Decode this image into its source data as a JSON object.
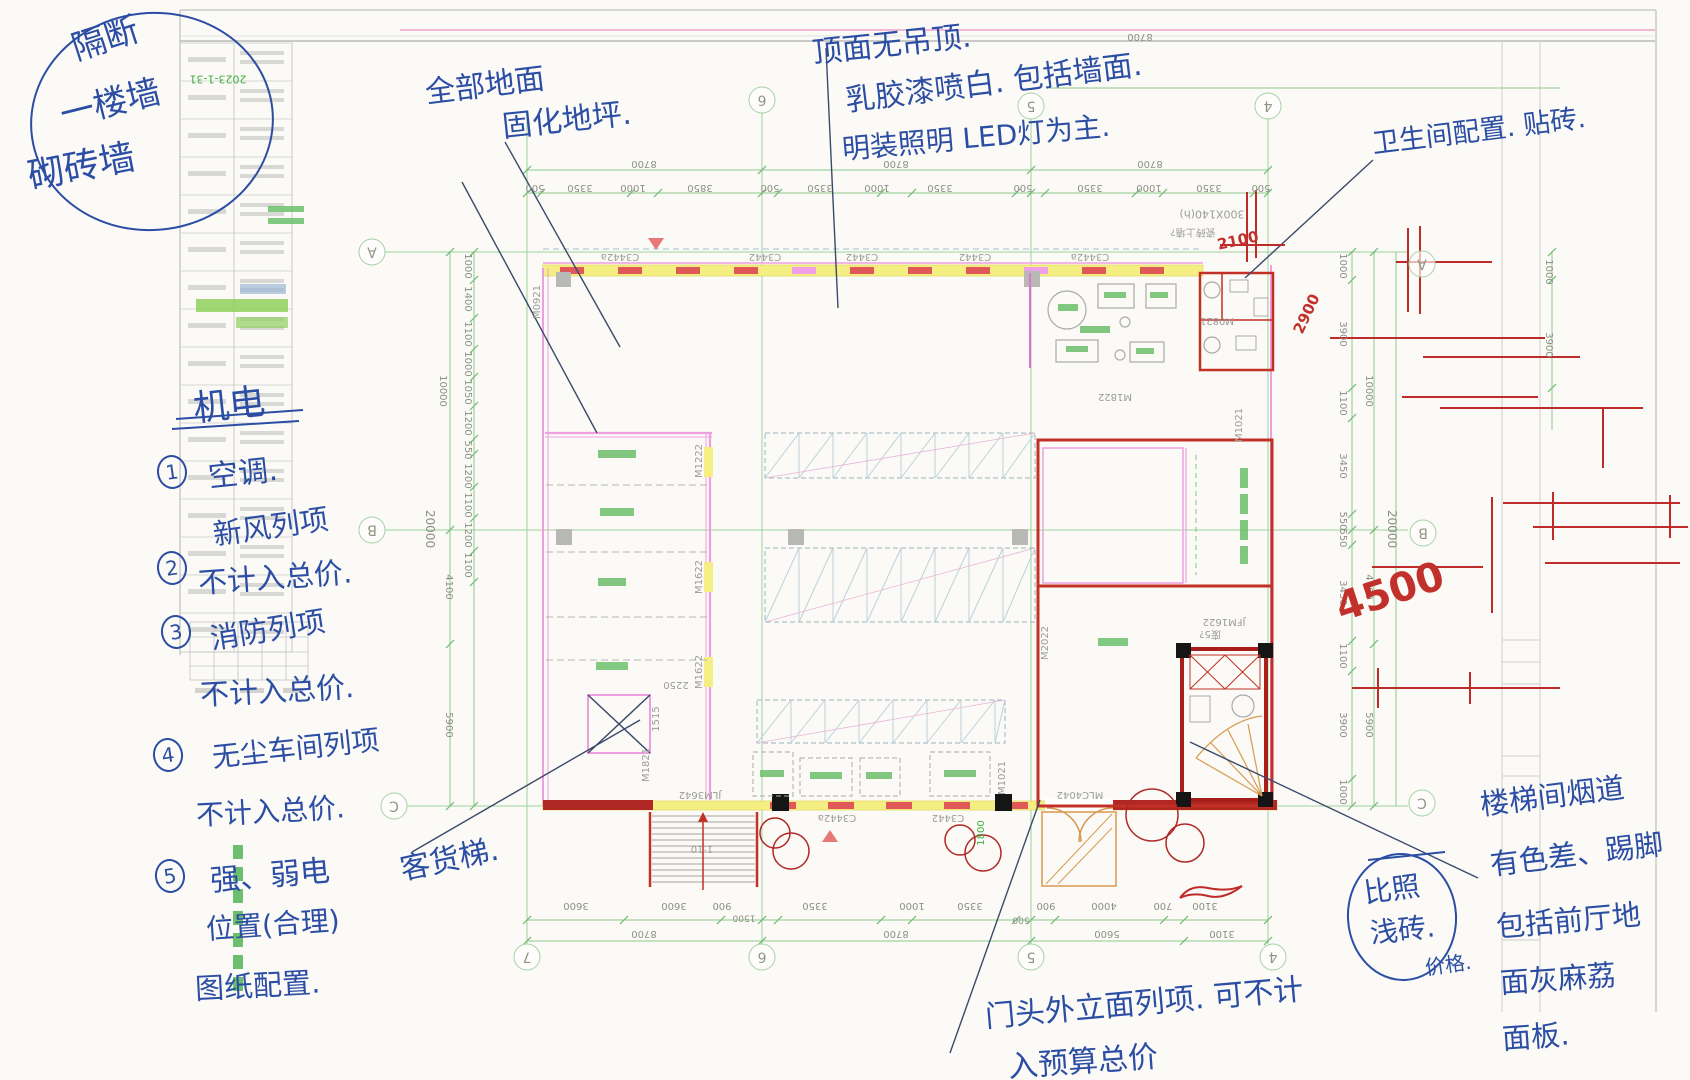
{
  "title_block": {
    "date": "2023-1-31"
  },
  "notes": {
    "circle": {
      "l1": "隔断",
      "l2": "一楼墙",
      "l3": "砌砖墙"
    },
    "floor": {
      "l1": "全部地面",
      "l2": "固化地坪."
    },
    "ceiling": {
      "l1": "顶面无吊顶.",
      "l2": "乳胶漆喷白. 包括墙面.",
      "l3": "明装照明 LED灯为主."
    },
    "washroom": "卫生间配置. 贴砖.",
    "mech": {
      "title": "机电",
      "n1": "1",
      "t1": "空调.",
      "n2": "2",
      "t2a": "新风列项",
      "t2b": "不计入总价.",
      "n3": "3",
      "t3a": "消防列项",
      "t3b": "不计入总价.",
      "n4": "4",
      "t4a": "无尘车间列项",
      "t4b": "不计入总价.",
      "n5": "5",
      "t5a": "强、弱电",
      "t5b": "位置(合理)",
      "t5c": "图纸配置."
    },
    "lift": "客货梯.",
    "entrance": {
      "l1": "门头外立面列项. 可不计",
      "l2": "入预算总价"
    },
    "stairwell": {
      "l1": "楼梯间烟道",
      "l2": "有色差、踢脚",
      "l3": "包括前厅地",
      "l4": "面灰麻荔",
      "l5": "面板."
    },
    "compare": {
      "l1": "比照",
      "l2": "浅砖.",
      "l3": "价格."
    }
  },
  "plan": {
    "labels": [
      {
        "t": "500",
        "x": 535,
        "y": 187,
        "r": 180,
        "k": "dim"
      },
      {
        "t": "3350",
        "x": 580,
        "y": 187,
        "r": 180,
        "k": "dim"
      },
      {
        "t": "1000",
        "x": 633,
        "y": 187,
        "r": 180,
        "k": "dim"
      },
      {
        "t": "3850",
        "x": 700,
        "y": 187,
        "r": 180,
        "k": "dim"
      },
      {
        "t": "500",
        "x": 770,
        "y": 187,
        "r": 180,
        "k": "dim"
      },
      {
        "t": "3350",
        "x": 820,
        "y": 187,
        "r": 180,
        "k": "dim"
      },
      {
        "t": "1000",
        "x": 877,
        "y": 187,
        "r": 180,
        "k": "dim"
      },
      {
        "t": "3350",
        "x": 940,
        "y": 187,
        "r": 180,
        "k": "dim"
      },
      {
        "t": "500",
        "x": 1023,
        "y": 187,
        "r": 180,
        "k": "dim"
      },
      {
        "t": "3350",
        "x": 1090,
        "y": 187,
        "r": 180,
        "k": "dim"
      },
      {
        "t": "1000",
        "x": 1149,
        "y": 187,
        "r": 180,
        "k": "dim"
      },
      {
        "t": "3350",
        "x": 1209,
        "y": 187,
        "r": 180,
        "k": "dim"
      },
      {
        "t": "500",
        "x": 1261,
        "y": 187,
        "r": 180,
        "k": "dim"
      },
      {
        "t": "8700",
        "x": 644,
        "y": 163,
        "r": 180,
        "k": "dim"
      },
      {
        "t": "8700",
        "x": 896,
        "y": 163,
        "r": 180,
        "k": "dim"
      },
      {
        "t": "8700",
        "x": 1150,
        "y": 163,
        "r": 180,
        "k": "dim"
      },
      {
        "t": "8700",
        "x": 1140,
        "y": 36,
        "r": 180,
        "k": "dim"
      },
      {
        "t": "3600",
        "x": 576,
        "y": 905,
        "r": 180,
        "k": "dim"
      },
      {
        "t": "3600",
        "x": 674,
        "y": 905,
        "r": 180,
        "k": "dim"
      },
      {
        "t": "900",
        "x": 722,
        "y": 905,
        "r": 180,
        "k": "dim"
      },
      {
        "t": "1500",
        "x": 744,
        "y": 917,
        "r": 180,
        "k": "dim",
        "s": 9
      },
      {
        "t": "3350",
        "x": 815,
        "y": 905,
        "r": 180,
        "k": "dim"
      },
      {
        "t": "1000",
        "x": 912,
        "y": 905,
        "r": 180,
        "k": "dim"
      },
      {
        "t": "3350",
        "x": 970,
        "y": 905,
        "r": 180,
        "k": "dim"
      },
      {
        "t": "500",
        "x": 1021,
        "y": 919,
        "r": 180,
        "k": "dim",
        "s": 9
      },
      {
        "t": "900",
        "x": 1046,
        "y": 905,
        "r": 180,
        "k": "dim"
      },
      {
        "t": "4000",
        "x": 1104,
        "y": 905,
        "r": 180,
        "k": "dim"
      },
      {
        "t": "700",
        "x": 1163,
        "y": 905,
        "r": 180,
        "k": "dim"
      },
      {
        "t": "3100",
        "x": 1205,
        "y": 905,
        "r": 180,
        "k": "dim"
      },
      {
        "t": "8700",
        "x": 644,
        "y": 933,
        "r": 180,
        "k": "dim"
      },
      {
        "t": "8700",
        "x": 896,
        "y": 933,
        "r": 180,
        "k": "dim"
      },
      {
        "t": "5600",
        "x": 1107,
        "y": 933,
        "r": 180,
        "k": "dim"
      },
      {
        "t": "3100",
        "x": 1222,
        "y": 933,
        "r": 180,
        "k": "dim"
      },
      {
        "t": "1000",
        "x": 467,
        "y": 266,
        "r": 90,
        "k": "dim"
      },
      {
        "t": "1400",
        "x": 467,
        "y": 299,
        "r": 90,
        "k": "dim"
      },
      {
        "t": "1100",
        "x": 467,
        "y": 334,
        "r": 90,
        "k": "dim"
      },
      {
        "t": "1000",
        "x": 467,
        "y": 364,
        "r": 90,
        "k": "dim"
      },
      {
        "t": "1050",
        "x": 467,
        "y": 392,
        "r": 90,
        "k": "dim"
      },
      {
        "t": "1200",
        "x": 467,
        "y": 423,
        "r": 90,
        "k": "dim"
      },
      {
        "t": "550",
        "x": 467,
        "y": 450,
        "r": 90,
        "k": "dim"
      },
      {
        "t": "1200",
        "x": 467,
        "y": 476,
        "r": 90,
        "k": "dim"
      },
      {
        "t": "1100",
        "x": 467,
        "y": 505,
        "r": 90,
        "k": "dim"
      },
      {
        "t": "1200",
        "x": 467,
        "y": 535,
        "r": 90,
        "k": "dim"
      },
      {
        "t": "1100",
        "x": 467,
        "y": 565,
        "r": 90,
        "k": "dim"
      },
      {
        "t": "10000",
        "x": 442,
        "y": 391,
        "r": 90,
        "k": "dim"
      },
      {
        "t": "20000",
        "x": 430,
        "y": 529,
        "r": 90,
        "k": "dim",
        "s": 12
      },
      {
        "t": "4100",
        "x": 448,
        "y": 587,
        "r": 90,
        "k": "dim"
      },
      {
        "t": "5900",
        "x": 448,
        "y": 725,
        "r": 90,
        "k": "dim"
      },
      {
        "t": "1000",
        "x": 1342,
        "y": 266,
        "r": 90,
        "k": "dim"
      },
      {
        "t": "3900",
        "x": 1342,
        "y": 334,
        "r": 90,
        "k": "dim"
      },
      {
        "t": "1100",
        "x": 1342,
        "y": 403,
        "r": 90,
        "k": "dim"
      },
      {
        "t": "3450",
        "x": 1342,
        "y": 466,
        "r": 90,
        "k": "dim"
      },
      {
        "t": "550",
        "x": 1342,
        "y": 521,
        "r": 90,
        "k": "dim"
      },
      {
        "t": "550",
        "x": 1342,
        "y": 538,
        "r": 90,
        "k": "dim"
      },
      {
        "t": "3450",
        "x": 1342,
        "y": 593,
        "r": 90,
        "k": "dim"
      },
      {
        "t": "1100",
        "x": 1342,
        "y": 656,
        "r": 90,
        "k": "dim"
      },
      {
        "t": "3900",
        "x": 1342,
        "y": 725,
        "r": 90,
        "k": "dim"
      },
      {
        "t": "1000",
        "x": 1342,
        "y": 792,
        "r": 90,
        "k": "dim"
      },
      {
        "t": "10000",
        "x": 1368,
        "y": 391,
        "r": 90,
        "k": "dim"
      },
      {
        "t": "20000",
        "x": 1392,
        "y": 529,
        "r": 90,
        "k": "dim",
        "s": 12
      },
      {
        "t": "4100",
        "x": 1368,
        "y": 587,
        "r": 90,
        "k": "dim"
      },
      {
        "t": "5900",
        "x": 1368,
        "y": 725,
        "r": 90,
        "k": "dim"
      },
      {
        "t": "1000",
        "x": 1548,
        "y": 272,
        "r": 90,
        "k": "dim"
      },
      {
        "t": "3900",
        "x": 1548,
        "y": 345,
        "r": 90,
        "k": "dim"
      },
      {
        "t": "1800",
        "x": 982,
        "y": 833,
        "r": -90,
        "k": "grn"
      },
      {
        "t": "2250",
        "x": 676,
        "y": 684,
        "r": 180,
        "k": "cad"
      },
      {
        "t": "1515",
        "x": 657,
        "y": 719,
        "r": -90,
        "k": "cad"
      },
      {
        "t": "1:10",
        "x": 702,
        "y": 848,
        "r": 180,
        "k": "cad"
      },
      {
        "t": "C3442a",
        "x": 620,
        "y": 256,
        "r": 180,
        "k": "cad"
      },
      {
        "t": "C3442",
        "x": 765,
        "y": 256,
        "r": 180,
        "k": "cad"
      },
      {
        "t": "C3442",
        "x": 862,
        "y": 256,
        "r": 180,
        "k": "cad"
      },
      {
        "t": "C3442",
        "x": 975,
        "y": 256,
        "r": 180,
        "k": "cad"
      },
      {
        "t": "C3442a",
        "x": 1090,
        "y": 256,
        "r": 180,
        "k": "cad"
      },
      {
        "t": "C3442a",
        "x": 837,
        "y": 817,
        "r": 180,
        "k": "cad"
      },
      {
        "t": "C3442",
        "x": 948,
        "y": 817,
        "r": 180,
        "k": "cad"
      },
      {
        "t": "JLM3642",
        "x": 700,
        "y": 794,
        "r": 180,
        "k": "cad"
      },
      {
        "t": "MLC4042",
        "x": 1080,
        "y": 794,
        "r": 180,
        "k": "cad"
      },
      {
        "t": "M0921",
        "x": 538,
        "y": 302,
        "r": -90,
        "k": "cad"
      },
      {
        "t": "M1222",
        "x": 700,
        "y": 461,
        "r": -90,
        "k": "cad"
      },
      {
        "t": "M1622",
        "x": 700,
        "y": 577,
        "r": -90,
        "k": "cad"
      },
      {
        "t": "M1622",
        "x": 700,
        "y": 672,
        "r": -90,
        "k": "cad"
      },
      {
        "t": "M1821",
        "x": 647,
        "y": 765,
        "r": -90,
        "k": "cad"
      },
      {
        "t": "M2022",
        "x": 1046,
        "y": 643,
        "r": -90,
        "k": "cad"
      },
      {
        "t": "M1021",
        "x": 1240,
        "y": 425,
        "r": -90,
        "k": "cad"
      },
      {
        "t": "M1021",
        "x": 1003,
        "y": 778,
        "r": -90,
        "k": "cad"
      },
      {
        "t": "M1822",
        "x": 1115,
        "y": 396,
        "r": 180,
        "k": "cad"
      },
      {
        "t": "JFM1622",
        "x": 1224,
        "y": 621,
        "r": 180,
        "k": "cad"
      },
      {
        "t": "废5?",
        "x": 1210,
        "y": 633,
        "r": 180,
        "k": "cad",
        "s": 10
      },
      {
        "t": "M0821",
        "x": 1217,
        "y": 320,
        "r": 180,
        "k": "cad"
      },
      {
        "t": "300X140(h)",
        "x": 1212,
        "y": 214,
        "r": 180,
        "k": "cad",
        "s": 11
      },
      {
        "t": "瓷砖上墙?",
        "x": 1193,
        "y": 231,
        "r": 180,
        "k": "cad",
        "s": 10
      },
      {
        "t": "6",
        "x": 762,
        "y": 100,
        "r": 180,
        "k": "bub"
      },
      {
        "t": "5",
        "x": 1031,
        "y": 106,
        "r": 180,
        "k": "bub"
      },
      {
        "t": "4",
        "x": 1268,
        "y": 106,
        "r": 180,
        "k": "bub"
      },
      {
        "t": "A",
        "x": 372,
        "y": 252,
        "r": 180,
        "k": "bub"
      },
      {
        "t": "B",
        "x": 372,
        "y": 530,
        "r": 180,
        "k": "bub"
      },
      {
        "t": "C",
        "x": 394,
        "y": 806,
        "r": 180,
        "k": "bub"
      },
      {
        "t": "A",
        "x": 1422,
        "y": 264,
        "r": 180,
        "k": "bub"
      },
      {
        "t": "B",
        "x": 1423,
        "y": 533,
        "r": 180,
        "k": "bub"
      },
      {
        "t": "C",
        "x": 1422,
        "y": 803,
        "r": 180,
        "k": "bub"
      },
      {
        "t": "7",
        "x": 527,
        "y": 957,
        "r": 180,
        "k": "bub"
      },
      {
        "t": "6",
        "x": 762,
        "y": 957,
        "r": 180,
        "k": "bub"
      },
      {
        "t": "5",
        "x": 1031,
        "y": 957,
        "r": 180,
        "k": "bub"
      },
      {
        "t": "4",
        "x": 1273,
        "y": 957,
        "r": 180,
        "k": "bub"
      },
      {
        "t": "2100",
        "x": 1238,
        "y": 241,
        "r": -12,
        "k": "redh",
        "s": 15
      },
      {
        "t": "2900",
        "x": 1307,
        "y": 314,
        "r": -65,
        "k": "redh",
        "s": 15
      },
      {
        "t": "4500",
        "x": 1390,
        "y": 592,
        "r": -18,
        "k": "redh",
        "s": 40
      },
      {
        "t": "2023-1-31",
        "x": 218,
        "y": 79,
        "r": 180,
        "k": "grn",
        "s": 11
      }
    ]
  }
}
